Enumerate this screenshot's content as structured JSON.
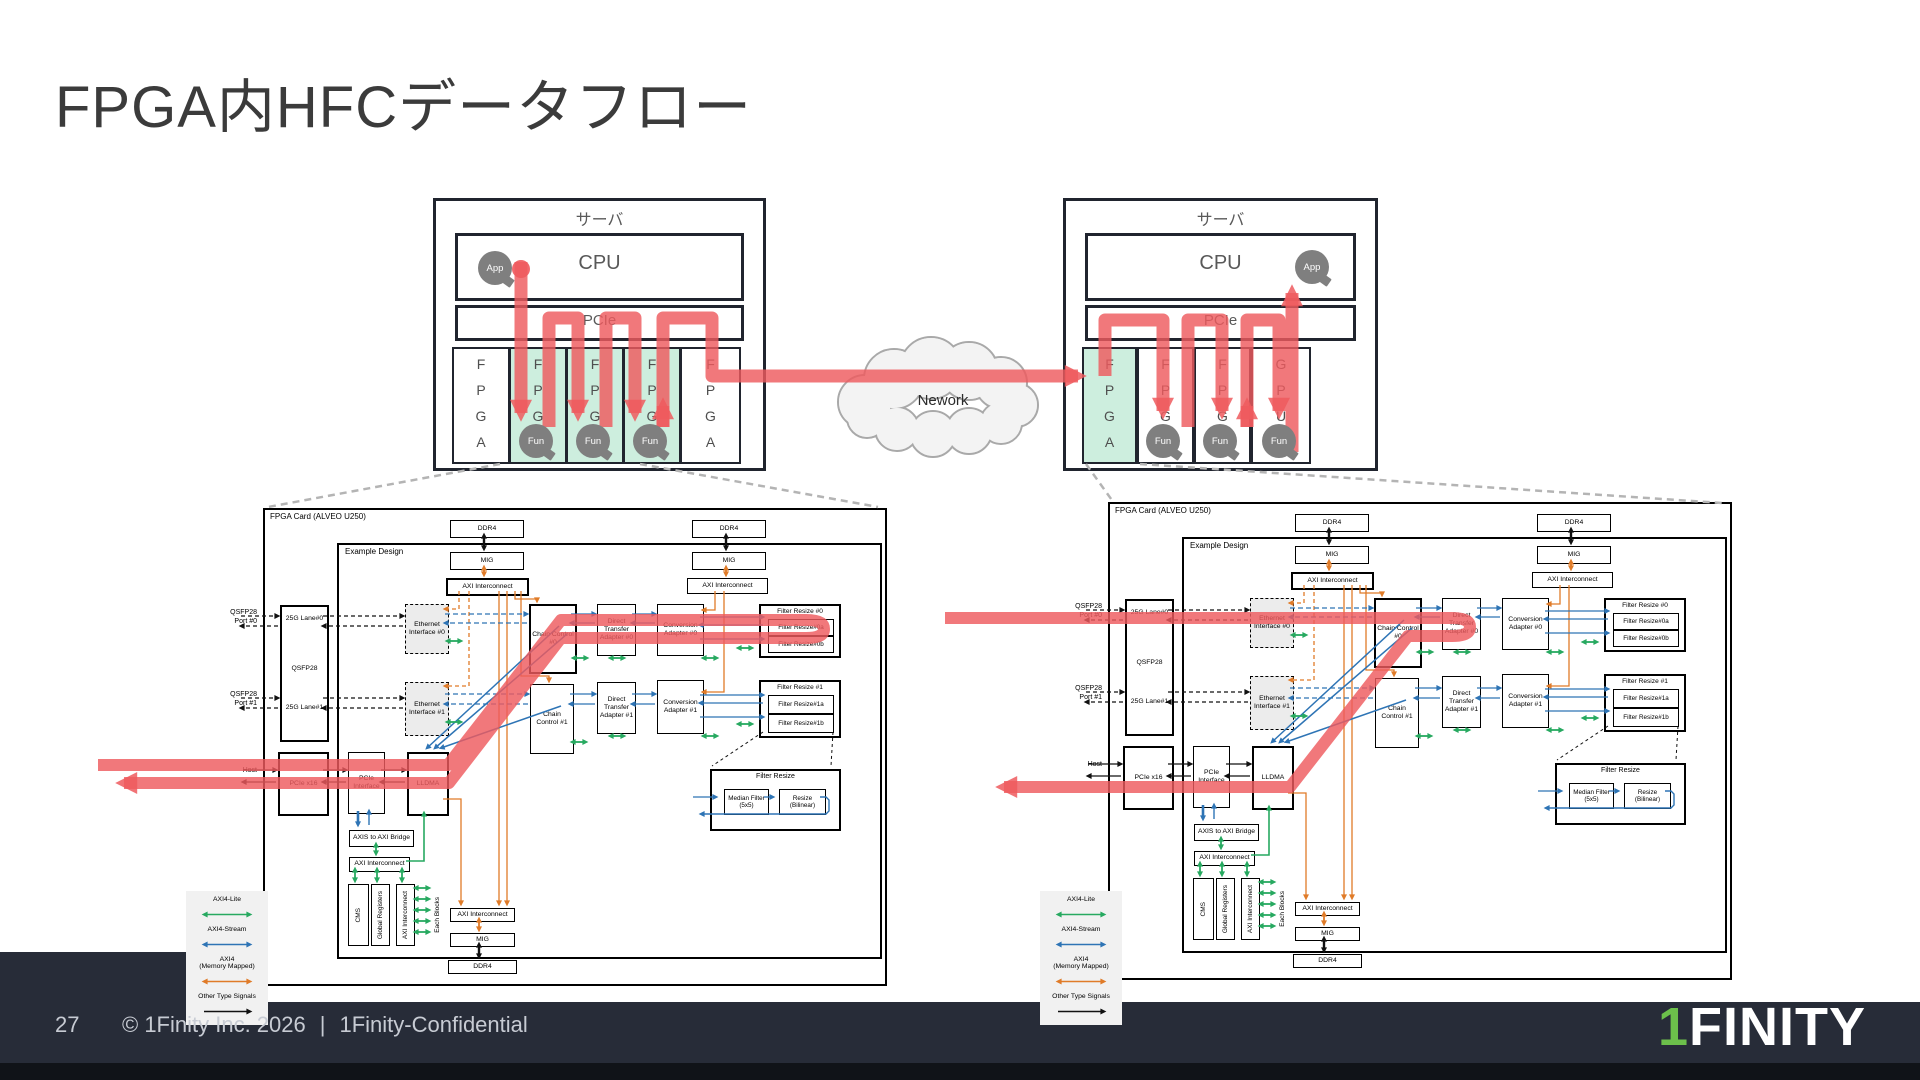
{
  "slide": {
    "title": "FPGA内HFCデータフロー",
    "page_number": "27",
    "copyright": "© 1Finity Inc. 2026",
    "divider": "|",
    "confidential": "1Finity-Confidential",
    "logo": {
      "prefix": "1",
      "rest": "FINITY"
    }
  },
  "network": {
    "label": "Nework"
  },
  "colors": {
    "flow_red": "#ee5a5e",
    "card_green": "#cdeede",
    "bubble_gray": "#7f7f7f",
    "axi_lite_green": "#27a960",
    "axi_stream_blue": "#2e74b5",
    "axi_mm_orange": "#e07b28",
    "other_black": "#111111",
    "footer_bg": "#272c38",
    "logo_green": "#6cc04b"
  },
  "servers": {
    "shared": {
      "title": "サーバ",
      "cpu": "CPU",
      "pcie": "PCIe",
      "app": "App",
      "fun": "Fun"
    },
    "left": {
      "cards": [
        {
          "label": "FPGA",
          "green": false,
          "fun": false
        },
        {
          "label": "FPGA",
          "green": true,
          "fun": true
        },
        {
          "label": "FPGA",
          "green": true,
          "fun": true
        },
        {
          "label": "FPGA",
          "green": true,
          "fun": true
        },
        {
          "label": "FPGA",
          "green": false,
          "fun": false
        }
      ]
    },
    "right": {
      "cards": [
        {
          "label": "FPGA",
          "green": true,
          "fun": false
        },
        {
          "label": "FPGA",
          "green": false,
          "fun": true
        },
        {
          "label": "FPGA",
          "green": false,
          "fun": true
        },
        {
          "label": "GPU",
          "green": false,
          "fun": true
        }
      ]
    }
  },
  "fpga_diagram": {
    "card_title": "FPGA Card (ALVEO U250)",
    "design_title": "Example Design",
    "outside": {
      "port0": "QSFP28\nPort #0",
      "port1": "QSFP28\nPort #1",
      "host": "Host"
    },
    "blocks": [
      {
        "id": "ddr4_a",
        "label": "DDR4",
        "x": 185,
        "y": 10,
        "w": 72,
        "h": 16
      },
      {
        "id": "mig_a",
        "label": "MIG",
        "x": 185,
        "y": 42,
        "w": 72,
        "h": 16
      },
      {
        "id": "axi_a",
        "label": "AXI Interconnect",
        "x": 181,
        "y": 68,
        "w": 79,
        "h": 14,
        "cls": "thick"
      },
      {
        "id": "ddr4_b",
        "label": "DDR4",
        "x": 427,
        "y": 10,
        "w": 72,
        "h": 16
      },
      {
        "id": "mig_b",
        "label": "MIG",
        "x": 427,
        "y": 42,
        "w": 72,
        "h": 16
      },
      {
        "id": "axi_b",
        "label": "AXI Interconnect",
        "x": 422,
        "y": 68,
        "w": 79,
        "h": 14
      },
      {
        "id": "qsfp",
        "label": "QSFP28",
        "x": 15,
        "y": 95,
        "w": 45,
        "h": 133,
        "cls": "thick",
        "labels": [
          "25G Lane#0",
          "QSFP28",
          "25G Lane#1"
        ]
      },
      {
        "id": "eth0",
        "label": "Ethernet Interface #0",
        "x": 140,
        "y": 94,
        "w": 42,
        "h": 48,
        "cls": "dashedB"
      },
      {
        "id": "eth1",
        "label": "Ethernet Interface #1",
        "x": 140,
        "y": 172,
        "w": 42,
        "h": 52,
        "cls": "dashedB"
      },
      {
        "id": "cc0",
        "label": "Chain Control #0",
        "x": 264,
        "y": 94,
        "w": 44,
        "h": 66,
        "cls": "thick"
      },
      {
        "id": "cc1",
        "label": "Chain Control #1",
        "x": 265,
        "y": 174,
        "w": 42,
        "h": 68
      },
      {
        "id": "dta0",
        "label": "Direct Transfer Adapter #0",
        "x": 332,
        "y": 94,
        "w": 37,
        "h": 50
      },
      {
        "id": "dta1",
        "label": "Direct Transfer Adapter #1",
        "x": 332,
        "y": 172,
        "w": 37,
        "h": 50
      },
      {
        "id": "ca0",
        "label": "Conversion Adapter #0",
        "x": 392,
        "y": 94,
        "w": 45,
        "h": 50
      },
      {
        "id": "ca1",
        "label": "Conversion Adapter #1",
        "x": 392,
        "y": 170,
        "w": 45,
        "h": 52
      },
      {
        "id": "fr0",
        "label": "Filter Resize #0",
        "x": 494,
        "y": 94,
        "w": 78,
        "h": 50,
        "cls": "thick",
        "subs": [
          "Filter Resize#0a",
          "Filter Resize#0b"
        ]
      },
      {
        "id": "fr1",
        "label": "Filter Resize #1",
        "x": 494,
        "y": 170,
        "w": 78,
        "h": 54,
        "cls": "thick",
        "subs": [
          "Filter Resize#1a",
          "Filter Resize#1b"
        ]
      },
      {
        "id": "pciex16",
        "label": "PCIe x16",
        "x": 13,
        "y": 242,
        "w": 47,
        "h": 60,
        "cls": "thick"
      },
      {
        "id": "pcieif",
        "label": "PCIe Interface",
        "x": 83,
        "y": 242,
        "w": 35,
        "h": 60
      },
      {
        "id": "lldma",
        "label": "LLDMA",
        "x": 142,
        "y": 242,
        "w": 38,
        "h": 60,
        "cls": "thick"
      },
      {
        "id": "bridge",
        "label": "AXIS to AXI Bridge",
        "x": 84,
        "y": 320,
        "w": 63,
        "h": 15
      },
      {
        "id": "axih",
        "label": "AXI Interconnect",
        "x": 84,
        "y": 347,
        "w": 59,
        "h": 13
      },
      {
        "id": "cms",
        "label": "CMS",
        "x": 83,
        "y": 374,
        "w": 19,
        "h": 60,
        "cls": "vert"
      },
      {
        "id": "greg",
        "label": "Global Registers",
        "x": 106,
        "y": 374,
        "w": 17,
        "h": 60,
        "cls": "vert"
      },
      {
        "id": "axiv",
        "label": "AXI Interconnect",
        "x": 131,
        "y": 374,
        "w": 17,
        "h": 60,
        "cls": "vert"
      },
      {
        "id": "eachblk",
        "label": "Each Blocks",
        "x": 166,
        "y": 376,
        "w": 14,
        "h": 58,
        "cls": "vlabel"
      },
      {
        "id": "axibot",
        "label": "AXI Interconnect",
        "x": 185,
        "y": 398,
        "w": 63,
        "h": 12
      },
      {
        "id": "migbot",
        "label": "MIG",
        "x": 185,
        "y": 423,
        "w": 63,
        "h": 12
      },
      {
        "id": "ddrbot",
        "label": "DDR4",
        "x": 183,
        "y": 450,
        "w": 67,
        "h": 12
      },
      {
        "id": "detail",
        "label": "Filter Resize",
        "x": 445,
        "y": 259,
        "w": 127,
        "h": 58,
        "cls": "thick",
        "subs": [
          "Median Filter\n(5x5)",
          "Resize\n(Bilinear)"
        ]
      }
    ],
    "legend": {
      "items": [
        {
          "label": "AXI4-Lite",
          "color": "#27a960",
          "style": "double"
        },
        {
          "label": "AXI4-Stream",
          "color": "#2e74b5",
          "style": "double"
        },
        {
          "label": "AXI4\n(Memory Mapped)",
          "color": "#e07b28",
          "style": "double"
        },
        {
          "label": "Other Type Signals",
          "color": "#111111",
          "style": "single"
        }
      ]
    }
  }
}
